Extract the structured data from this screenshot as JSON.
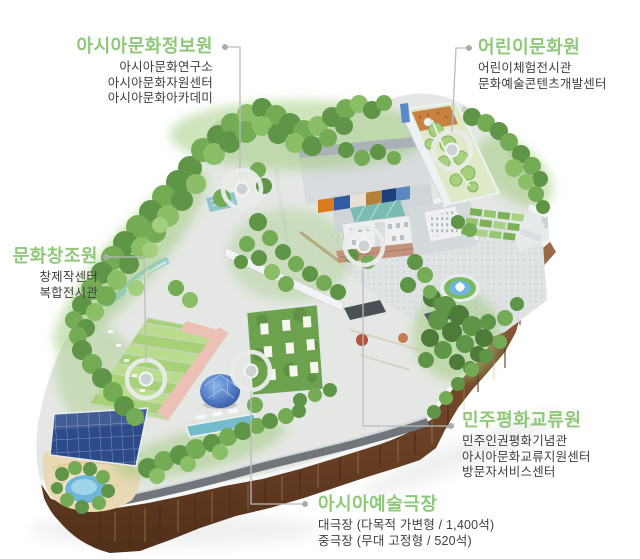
{
  "colors": {
    "accent_green": "#8ec878",
    "body_text": "#3e3f3e",
    "connector_gray": "#b9bdbd",
    "foliage_green": "#5f9547",
    "cliff_brown": "#7a4c2c",
    "water_blue": "#6fb6d8",
    "solar_blue": "#2c4b88"
  },
  "labels": {
    "info_center": {
      "title": "아시아문화정보원",
      "items": [
        "아시아문화연구소",
        "아시아문화자원센터",
        "아시아문화아카데미"
      ]
    },
    "children_center": {
      "title": "어린이문화원",
      "items": [
        "어린이체험전시관",
        "문화예술콘텐츠개발센터"
      ]
    },
    "culture_creation": {
      "title": "문화창조원",
      "items": [
        "창제작센터",
        "복합전시관"
      ]
    },
    "democracy_peace": {
      "title": "민주평화교류원",
      "items": [
        "민주인권평화기념관",
        "아시아문화교류지원센터",
        "방문자서비스센터"
      ]
    },
    "arts_theater": {
      "title": "아시아예술극장",
      "items": [
        "대극장 (다목적 가변형 / 1,400석)",
        "중극장 (무대 고정형 / 520석)"
      ]
    }
  }
}
